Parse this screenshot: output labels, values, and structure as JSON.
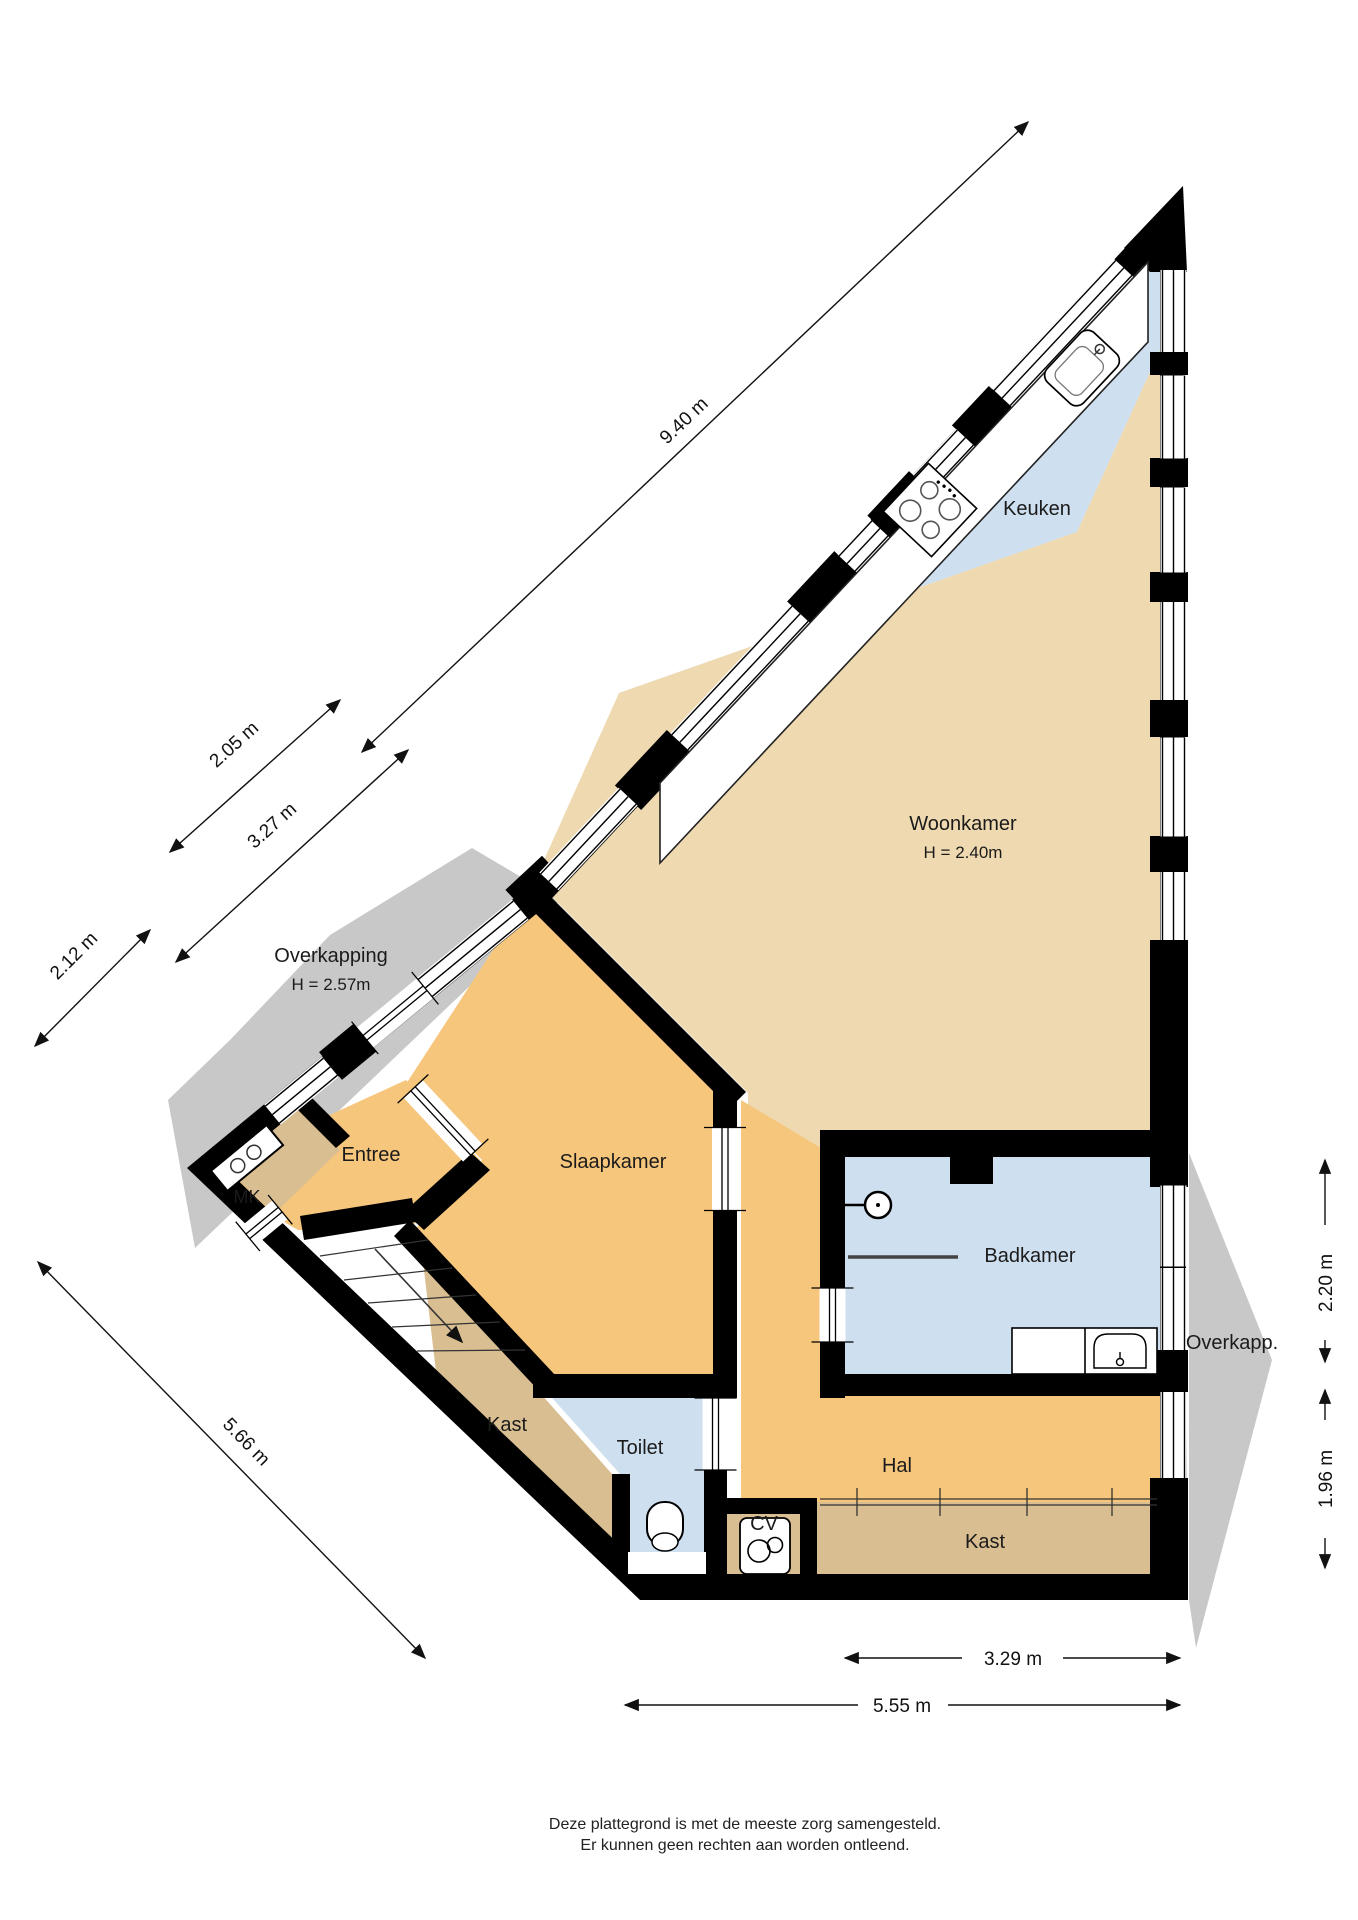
{
  "plan": {
    "rooms": {
      "keuken": {
        "label": "Keuken"
      },
      "woonkamer": {
        "label": "Woonkamer",
        "height_label": "H = 2.40m"
      },
      "overkapping_left": {
        "label": "Overkapping",
        "height_label": "H = 2.57m"
      },
      "entree": {
        "label": "Entree"
      },
      "mk": {
        "label": "MK"
      },
      "slaapkamer": {
        "label": "Slaapkamer"
      },
      "badkamer": {
        "label": "Badkamer"
      },
      "overkapping_right": {
        "label": "Overkapp."
      },
      "kast_left": {
        "label": "Kast"
      },
      "toilet": {
        "label": "Toilet"
      },
      "hal": {
        "label": "Hal"
      },
      "cv": {
        "label": "CV"
      },
      "kast_bottom": {
        "label": "Kast"
      }
    },
    "dimensions": {
      "diagonal_total": "9.40 m",
      "entree_upper": "2.05 m",
      "entree_mid": "3.27 m",
      "entree_lower": "2.12 m",
      "right_upper": "2.20 m",
      "right_lower": "1.96 m",
      "bottom_left_diagonal": "5.66 m",
      "bottom_inner": "3.29 m",
      "bottom_total": "5.55 m"
    },
    "colors": {
      "living_tan": "#EFD9B0",
      "rooms_orange": "#F6C67C",
      "closet_tan": "#D9BE92",
      "wet_blue": "#CEDFEF",
      "canopy_gray": "#C8C8C8",
      "wall": "#000000"
    },
    "footer": {
      "line1": "Deze plattegrond is met de meeste zorg samengesteld.",
      "line2": "Er kunnen geen rechten aan worden ontleend."
    }
  }
}
